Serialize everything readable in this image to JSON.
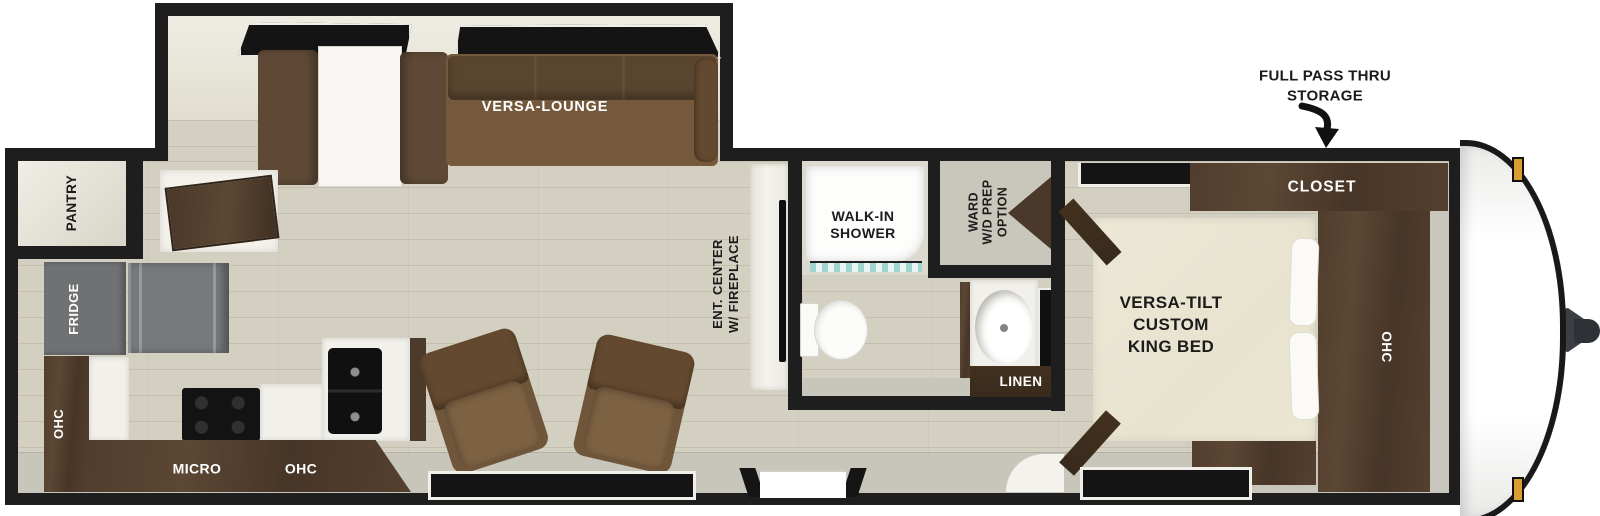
{
  "annotation": {
    "full_pass_thru_line1": "FULL PASS THRU",
    "full_pass_thru_line2": "STORAGE"
  },
  "rooms": {
    "slideout": {
      "versa_lounge": "VERSA-LOUNGE"
    },
    "kitchen": {
      "pantry": "PANTRY",
      "fridge": "FRIDGE",
      "ohc_left": "OHC",
      "micro": "MICRO",
      "ohc_bottom": "OHC"
    },
    "living": {
      "ent_center_line1": "ENT. CENTER",
      "ent_center_line2": "W/ FIREPLACE"
    },
    "bathroom": {
      "shower_line1": "WALK-IN",
      "shower_line2": "SHOWER",
      "ward_line1": "WARD",
      "ward_line2": "W/D PREP",
      "ward_line3": "OPTION",
      "linen": "LINEN"
    },
    "bedroom": {
      "bed_line1": "VERSA-TILT",
      "bed_line2": "CUSTOM",
      "bed_line3": "KING BED",
      "closet": "CLOSET",
      "ohc": "OHC"
    }
  },
  "colors": {
    "wall": "#1e1e1e",
    "floor_wood": "#d4d0c1",
    "cabinet_brown": "#4a3729",
    "sofa_brown": "#6b523a",
    "chair_brown": "#76593c",
    "bed_cream": "#ebe7d3",
    "fridge_gray": "#6f7173",
    "marker_light_amber": "#d99e2f",
    "shower_glass_teal": "#9fd4cf"
  }
}
